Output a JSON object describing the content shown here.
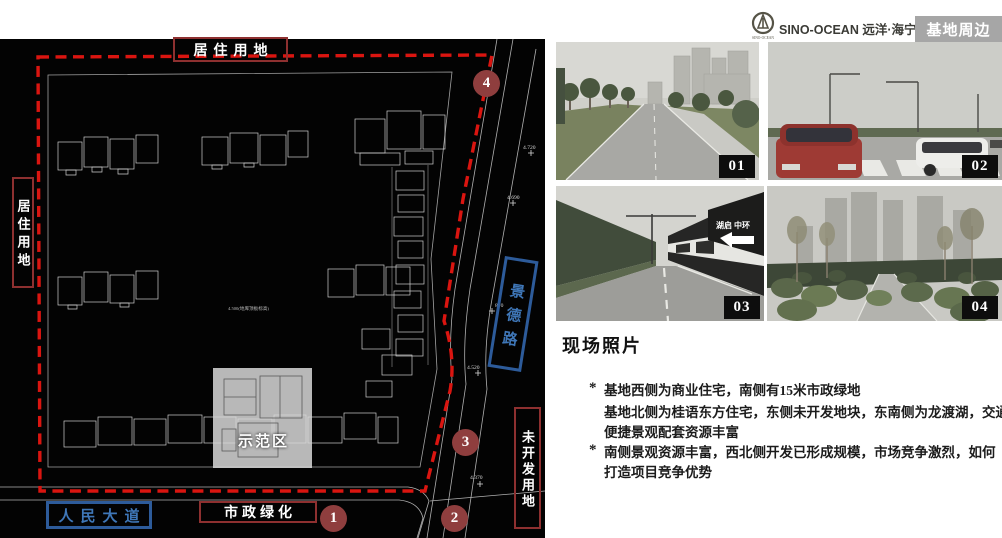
{
  "header": {
    "brand": "SINO-OCEAN 远洋·海宁许村——",
    "badge": "基地周边",
    "logo_caption": "SINO-OCEAN"
  },
  "plan": {
    "label_top": "居住用地",
    "label_left": "居住用地",
    "road_right": "景德路",
    "label_bottom_right": "未开发用地",
    "label_bottom": "市政绿化",
    "road_bottom": "人民大道",
    "demo_zone": "示范区",
    "note_center": "4.500(地库顶板标高)",
    "elevations": {
      "e1": "4.720",
      "e2": "4.690",
      "e3": "870",
      "e4": "4.520",
      "e5": "4.370"
    },
    "markers": {
      "m1": "1",
      "m2": "2",
      "m3": "3",
      "m4": "4"
    },
    "colors": {
      "boundary_dash": "#da1510",
      "red_box": "#8e3030",
      "blue_box": "#2d5b9a",
      "marker_fill": "#8f3e3e"
    }
  },
  "photos": {
    "p1": "01",
    "p2": "02",
    "p3": "03",
    "p4": "04",
    "sign3": "湖启 中环"
  },
  "notes": {
    "title": "现场照片",
    "mark": "*",
    "b1l1": "基地西侧为商业住宅，南侧有15米市政绿地",
    "b1l2": "基地北侧为桂语东方住宅，东侧未开发地块，东南侧为龙渡湖，交通",
    "b1l3": "便捷景观配套资源丰富",
    "b2l1": "南侧景观资源丰富，西北侧开发已形成规模，市场竞争激烈，如何",
    "b2l2": "打造项目竞争优势"
  }
}
